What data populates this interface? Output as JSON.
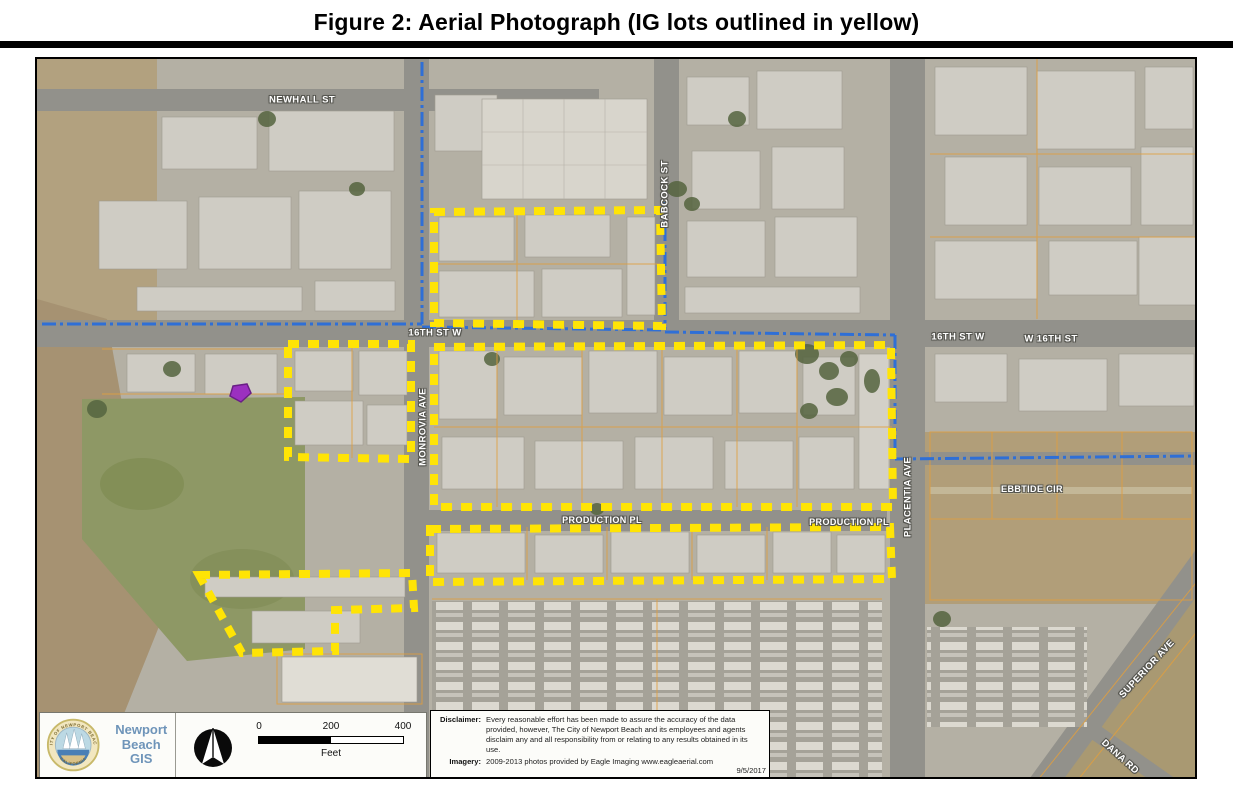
{
  "figure": {
    "title": "Figure 2: Aerial Photograph (IG lots outlined in yellow)"
  },
  "colors": {
    "ig_lot_yellow": "#FFE405",
    "city_boundary_blue": "#2F6FD6",
    "parcel_line_orange": "#E09F3E",
    "gis_logo_blue": "#6E94B9"
  },
  "map": {
    "street_labels": [
      {
        "id": "newhall-st",
        "text": "NEWHALL ST"
      },
      {
        "id": "16th-st-w-west",
        "text": "16TH ST W"
      },
      {
        "id": "16th-st-w-east",
        "text": "16TH ST W"
      },
      {
        "id": "w-16th-st",
        "text": "W 16TH ST"
      },
      {
        "id": "babcock-st",
        "text": "BABCOCK ST"
      },
      {
        "id": "monrovia-ave",
        "text": "MONROVIA AVE"
      },
      {
        "id": "production-pl-west",
        "text": "PRODUCTION PL"
      },
      {
        "id": "production-pl-east",
        "text": "PRODUCTION PL"
      },
      {
        "id": "placentia-ave",
        "text": "PLACENTIA AVE"
      },
      {
        "id": "ebbtide-cir",
        "text": "EBBTIDE CIR"
      },
      {
        "id": "superior-ave",
        "text": "SUPERIOR AVE"
      },
      {
        "id": "dana-rd",
        "text": "DANA RD"
      }
    ],
    "ig_lot_outlines": [
      {
        "id": "north-lot",
        "points": "397,153 623,151 625,267 397,264"
      },
      {
        "id": "west-lot",
        "points": "251,285 374,285 374,400 251,398"
      },
      {
        "id": "central-lot",
        "points": "397,288 854,286 856,448 397,448"
      },
      {
        "id": "south-lot",
        "points": "393,470 853,468 855,520 393,523"
      },
      {
        "id": "southwest-lot",
        "points": "162,516 375,514 377,549 298,551 298,592 205,594"
      }
    ],
    "city_boundary_segments": [
      "385,3 385,265",
      "5,265 385,265",
      "385,268 628,271",
      "628,143 628,271",
      "628,273 858,276",
      "858,276 858,400",
      "858,400 1160,397"
    ]
  },
  "legend": {
    "org_lines": [
      "Newport",
      "Beach",
      "GIS"
    ],
    "seal_top": "CITY OF NEWPORT BEACH",
    "seal_bottom": "CALIFORNIA",
    "scale": {
      "ticks": [
        "0",
        "200",
        "400"
      ],
      "unit": "Feet"
    }
  },
  "disclaimer": {
    "label": "Disclaimer:",
    "text": "Every reasonable effort has been made to assure the accuracy of the data provided, however, The City of Newport Beach and its employees and agents disclaim any and all responsibility from or relating to any results obtained in its use.",
    "imagery_label": "Imagery:",
    "imagery_text": "2009-2013 photos provided by Eagle Imaging www.eagleaerial.com",
    "date": "9/5/2017"
  }
}
